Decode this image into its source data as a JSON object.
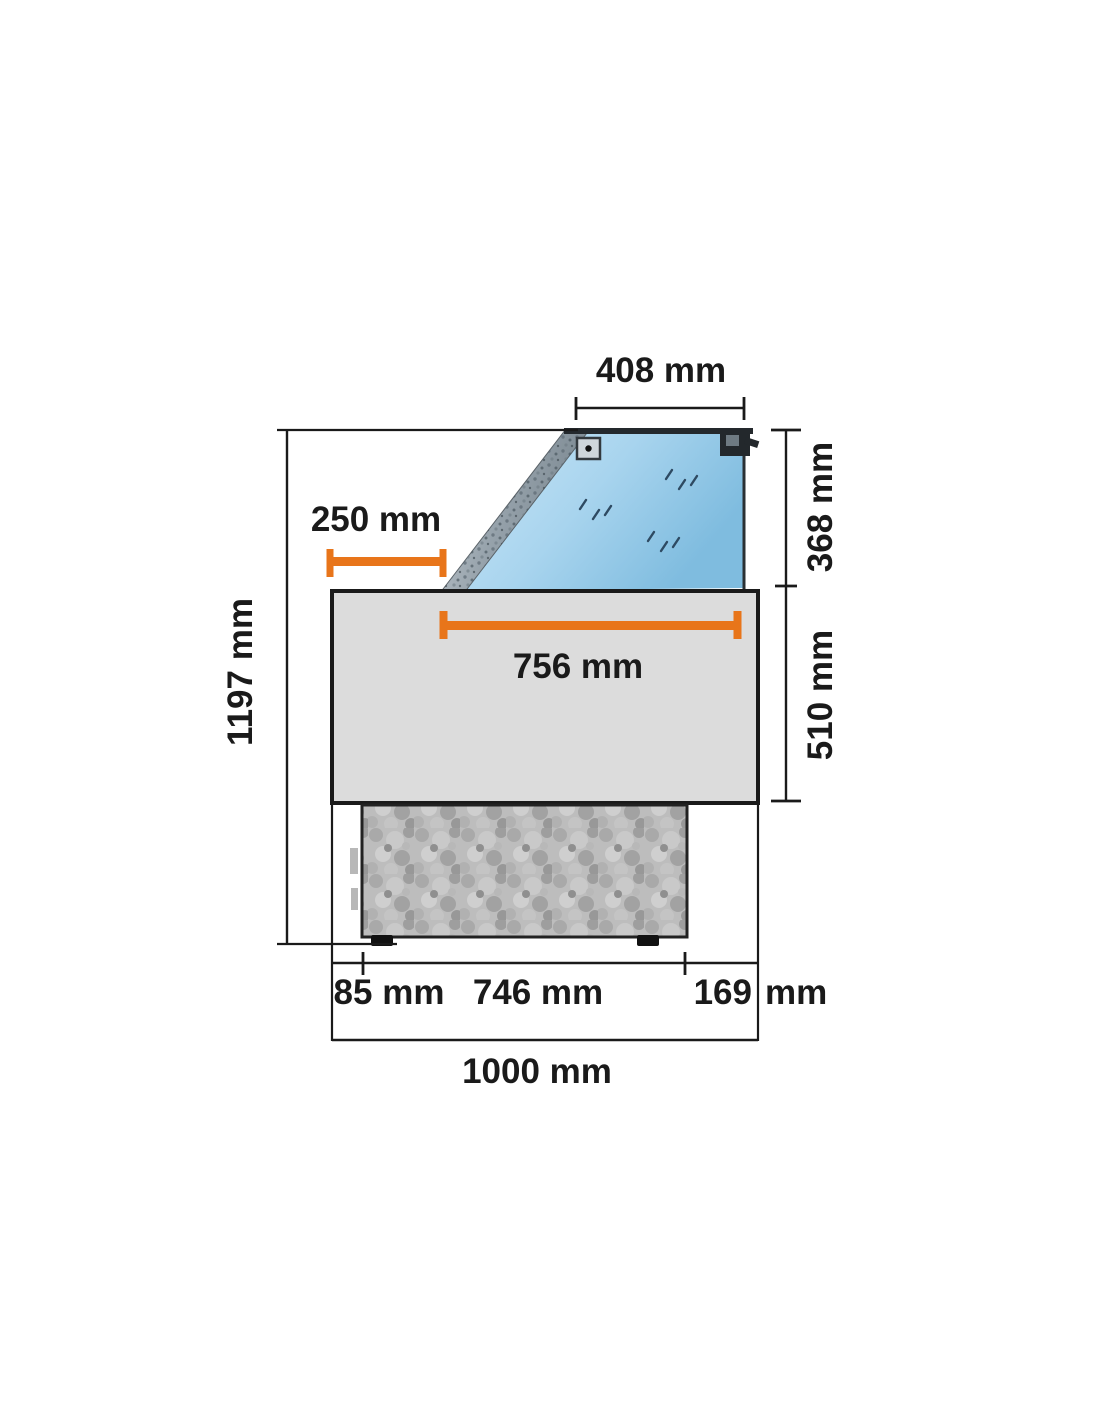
{
  "diagram": {
    "type": "technical-dimension-drawing",
    "subject": "refrigerated display case side profile with dimension callouts",
    "units": "mm",
    "labels": {
      "top_glass_width": "408 mm",
      "glass_height": "368 mm",
      "body_height": "510 mm",
      "total_height": "1197 mm",
      "top_inset": "250 mm",
      "display_surface_width": "756 mm",
      "front_offset": "85 mm",
      "base_width": "746 mm",
      "rear_offset_value": "169",
      "rear_offset_unit": "mm",
      "total_width": "1000 mm"
    },
    "colors": {
      "dimension_accent": "#E8751A",
      "line": "#1A1A1A",
      "glass_light": "#CDE8F8",
      "glass_dark": "#7FBCDF",
      "body_fill": "#DCDCDC",
      "base_fill": "#BDBDBD"
    }
  }
}
